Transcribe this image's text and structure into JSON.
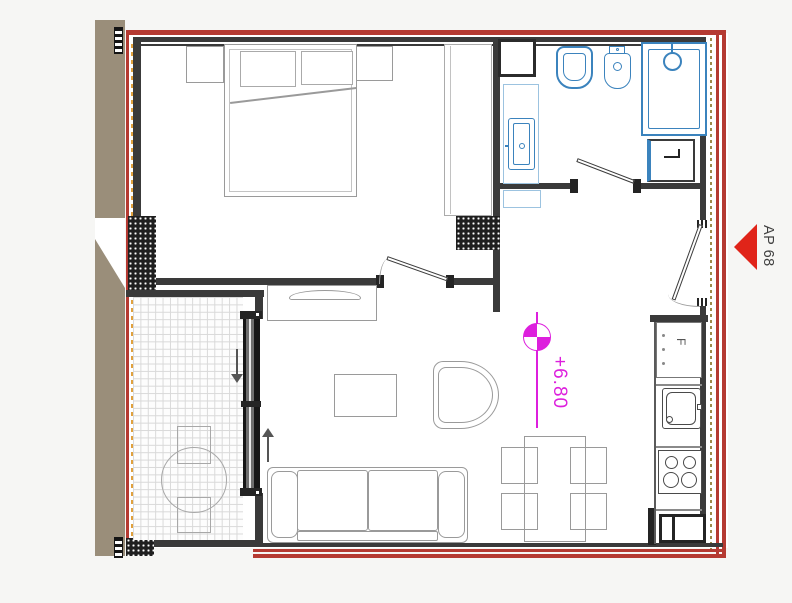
{
  "plan": {
    "apartment_marker": {
      "label": "AP 68"
    },
    "level_marker": {
      "value": "+6.80"
    },
    "kitchen": {
      "fridge_label": "F"
    },
    "rooms": [
      "bedroom",
      "bathroom",
      "hall",
      "living-dining",
      "kitchen",
      "balcony"
    ],
    "colors": {
      "boundary_red": "#b53a32",
      "entrance_arrow_red": "#e02419",
      "wall_dark": "#3a3a3a",
      "fixture_blue": "#3b83bd",
      "counter_light_blue": "#9cc3e0",
      "level_magenta": "#dd1fdd",
      "neighbor_tan": "#9a8e7a",
      "furniture_line_gray": "#9a9a9a",
      "insulation_orange": "#e0a13e",
      "insulation_olive": "#9c8b4a"
    },
    "icons": {
      "entrance_arrow": "left-pointing-triangle",
      "level_symbol": "quartered-survey-circle",
      "balcony_arrows": [
        "arrow-down",
        "arrow-up"
      ]
    }
  }
}
